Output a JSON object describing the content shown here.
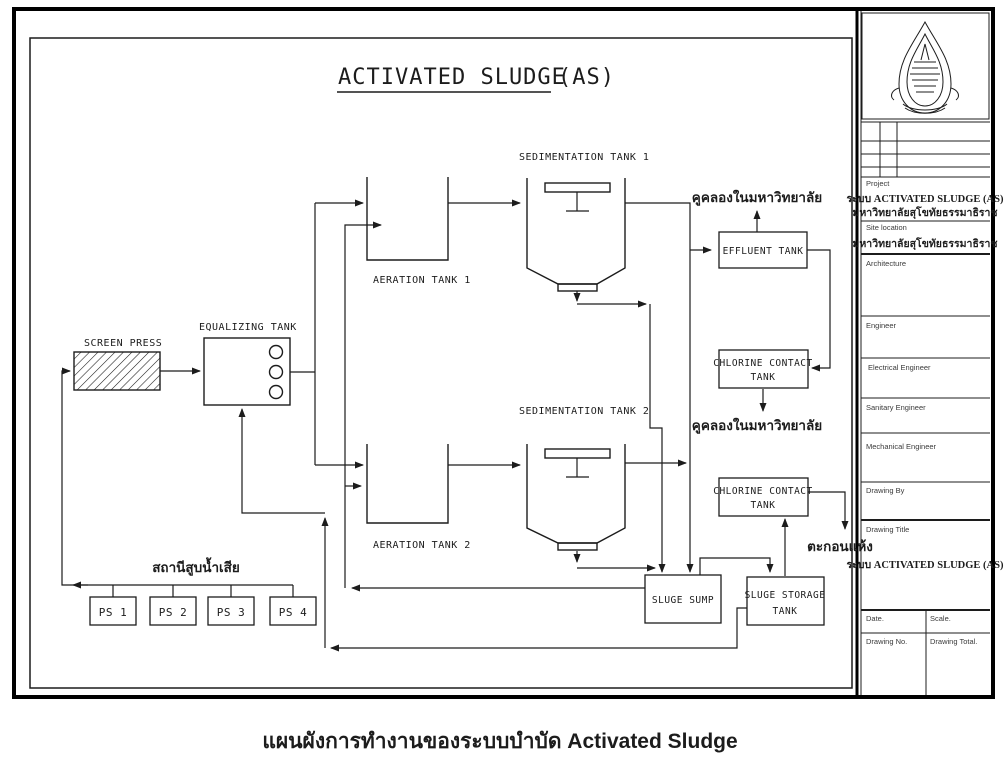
{
  "colors": {
    "ink": "#1c1c1c",
    "paper": "#ffffff"
  },
  "diagram": {
    "title": "ACTIVATED SLUDGE",
    "title_suffix": "(AS)",
    "units": {
      "screen_press": "SCREEN PRESS",
      "equalizing_tank": "EQUALIZING TANK",
      "aeration_tank_1": "AERATION TANK 1",
      "aeration_tank_2": "AERATION TANK 2",
      "sedimentation_tank_1": "SEDIMENTATION TANK 1",
      "sedimentation_tank_2": "SEDIMENTATION TANK 2",
      "effluent_tank": "EFFLUENT TANK",
      "chlorine_contact_line1": "CHLORINE CONTACT",
      "chlorine_contact_line2": "TANK",
      "sludge_sump": "SLUGE SUMP",
      "sludge_storage_line1": "SLUGE STORAGE",
      "sludge_storage_line2": "TANK"
    },
    "pump_stations": [
      {
        "label": "PS 1"
      },
      {
        "label": "PS 2"
      },
      {
        "label": "PS 3"
      },
      {
        "label": "PS 4"
      }
    ],
    "annotations": {
      "canal_from_effluent": "คูคลองในมหาวิทยาลัย",
      "canal_from_chlorine": "คูคลองในมหาวิทยาลัย",
      "dried_sludge": "ตะกอนแห้ง",
      "pump_station_group": "สถานีสูบน้ำเสีย"
    }
  },
  "title_block": {
    "project_label": "Project",
    "project_line1": "ระบบ ACTIVATED SLUDGE (AS)",
    "project_line2": "มหาวิทยาลัยสุโขทัยธรรมาธิราช",
    "site_location_label": "Site location",
    "site_location_value": "มหาวิทยาลัยสุโขทัยธรรมาธิราช",
    "architecture_label": "Architecture",
    "engineer_label": "Engineer",
    "electrical_engineer_label": "Electrical Engineer",
    "sanitary_engineer_label": "Sanitary Engineer",
    "mechanical_engineer_label": "Mechanical Engineer",
    "drawing_by_label": "Drawing By",
    "drawing_title_label": "Drawing Title",
    "drawing_title_value": "ระบบ ACTIVATED SLUDGE (AS)",
    "date_label": "Date.",
    "scale_label": "Scale.",
    "drawing_no_label": "Drawing No.",
    "drawing_total_label": "Drawing Total."
  },
  "caption": "แผนผังการทำงานของระบบบำบัด Activated Sludge"
}
